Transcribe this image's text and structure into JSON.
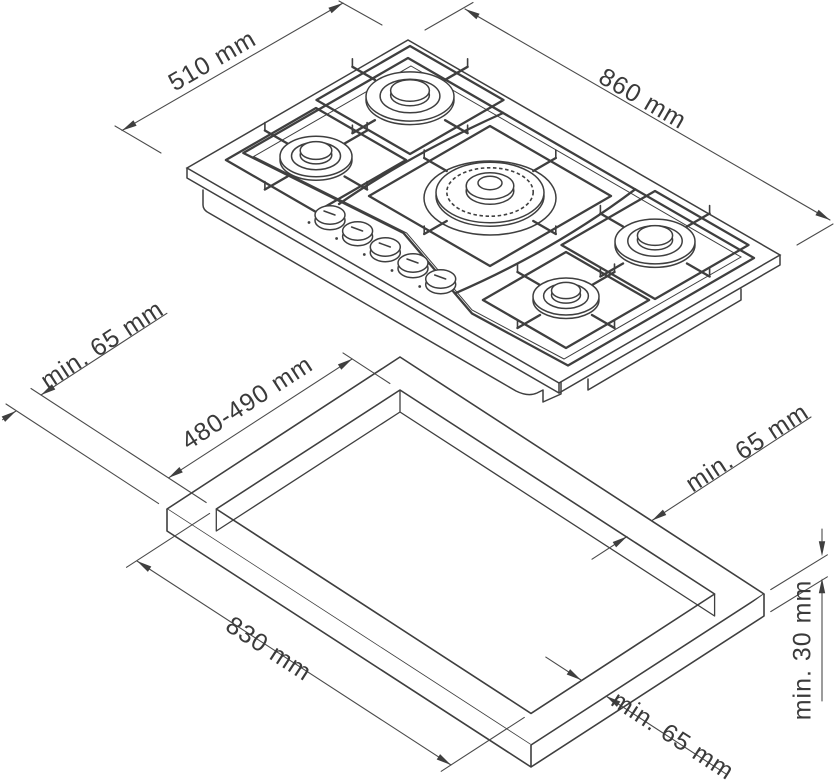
{
  "drawing": {
    "type": "installation-technical-drawing",
    "background": "#ffffff",
    "line_color": "#3f3f3f",
    "text_color": "#3a3a3a",
    "hob_view": {
      "description": "isometric view of 5-burner gas hob",
      "burner_count": 5,
      "knob_count": 5,
      "dims": {
        "depth": "510 mm",
        "width": "860 mm"
      }
    },
    "worktop_view": {
      "description": "isometric view of worktop with rectangular cutout",
      "dims": {
        "clearance_back_left": "min. 65 mm",
        "cutout_depth": "480-490 mm",
        "clearance_back_right": "min. 65 mm",
        "cutout_width": "830 mm",
        "clearance_front_right": "min. 65 mm",
        "worktop_thickness": "min. 30 mm"
      }
    }
  }
}
